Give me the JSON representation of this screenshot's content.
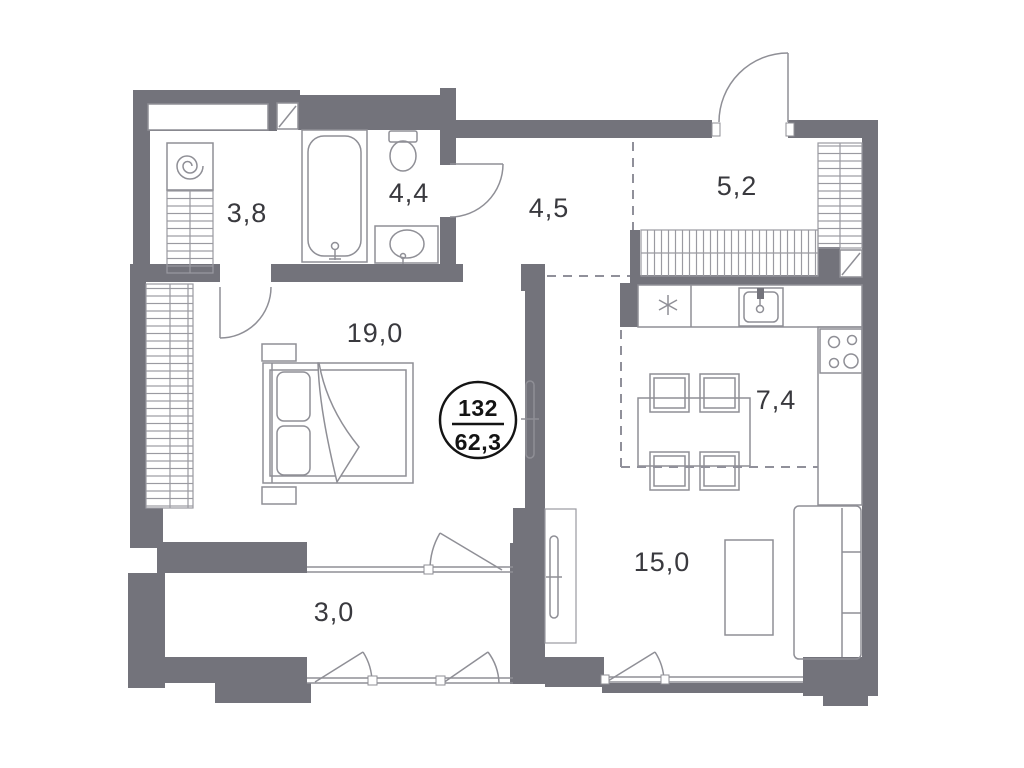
{
  "plan": {
    "title": "apartment-floor-plan",
    "badge": {
      "number": "132",
      "area": "62,3"
    },
    "rooms": [
      {
        "id": "wardrobe-room",
        "area_label": "3,8"
      },
      {
        "id": "bathroom",
        "area_label": "4,4"
      },
      {
        "id": "hallway",
        "area_label": "4,5"
      },
      {
        "id": "entry",
        "area_label": "5,2"
      },
      {
        "id": "bedroom",
        "area_label": "19,0"
      },
      {
        "id": "kitchen",
        "area_label": "7,4"
      },
      {
        "id": "living-room",
        "area_label": "15,0"
      },
      {
        "id": "balcony",
        "area_label": "3,0"
      }
    ],
    "colors": {
      "wall": "#73737b",
      "furniture_line": "#8f8f96",
      "text": "#39393e",
      "badge_ring": "#141414",
      "background": "#ffffff"
    }
  }
}
